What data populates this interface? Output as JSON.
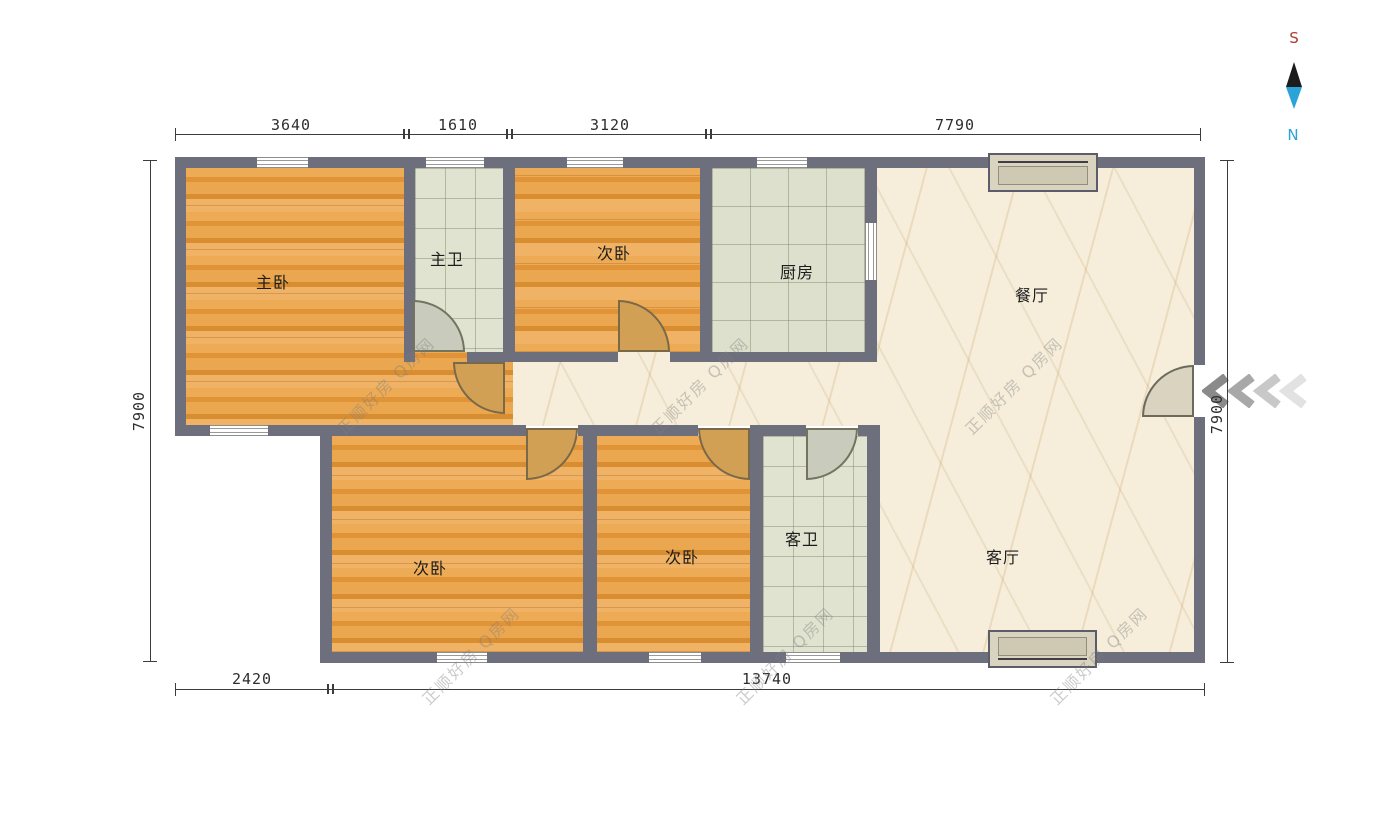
{
  "plan": {
    "rooms": [
      {
        "key": "master-bedroom",
        "label": "主卧"
      },
      {
        "key": "master-bath",
        "label": "主卫"
      },
      {
        "key": "bedroom-top",
        "label": "次卧"
      },
      {
        "key": "kitchen",
        "label": "厨房"
      },
      {
        "key": "dining",
        "label": "餐厅"
      },
      {
        "key": "bedroom-bottom-left",
        "label": "次卧"
      },
      {
        "key": "bedroom-bottom-right",
        "label": "次卧"
      },
      {
        "key": "guest-bath",
        "label": "客卫"
      },
      {
        "key": "living",
        "label": "客厅"
      }
    ]
  },
  "dimensions": {
    "top": [
      "3640",
      "1610",
      "3120",
      "7790"
    ],
    "bottom": [
      "2420",
      "13740"
    ],
    "left": "7900",
    "right": "7900"
  },
  "compass": {
    "south": "S",
    "north": "N"
  },
  "watermark": {
    "text": "正顺好房 Q房网"
  },
  "colors": {
    "wall": "#6e6f7d",
    "wood_floor": "#e7a349",
    "tile_floor": "#e0e3d0",
    "marble_floor": "#f6eedb",
    "door_wood": "#d2a055",
    "south_label": "#b03a30",
    "north_label": "#2aa3d8"
  }
}
